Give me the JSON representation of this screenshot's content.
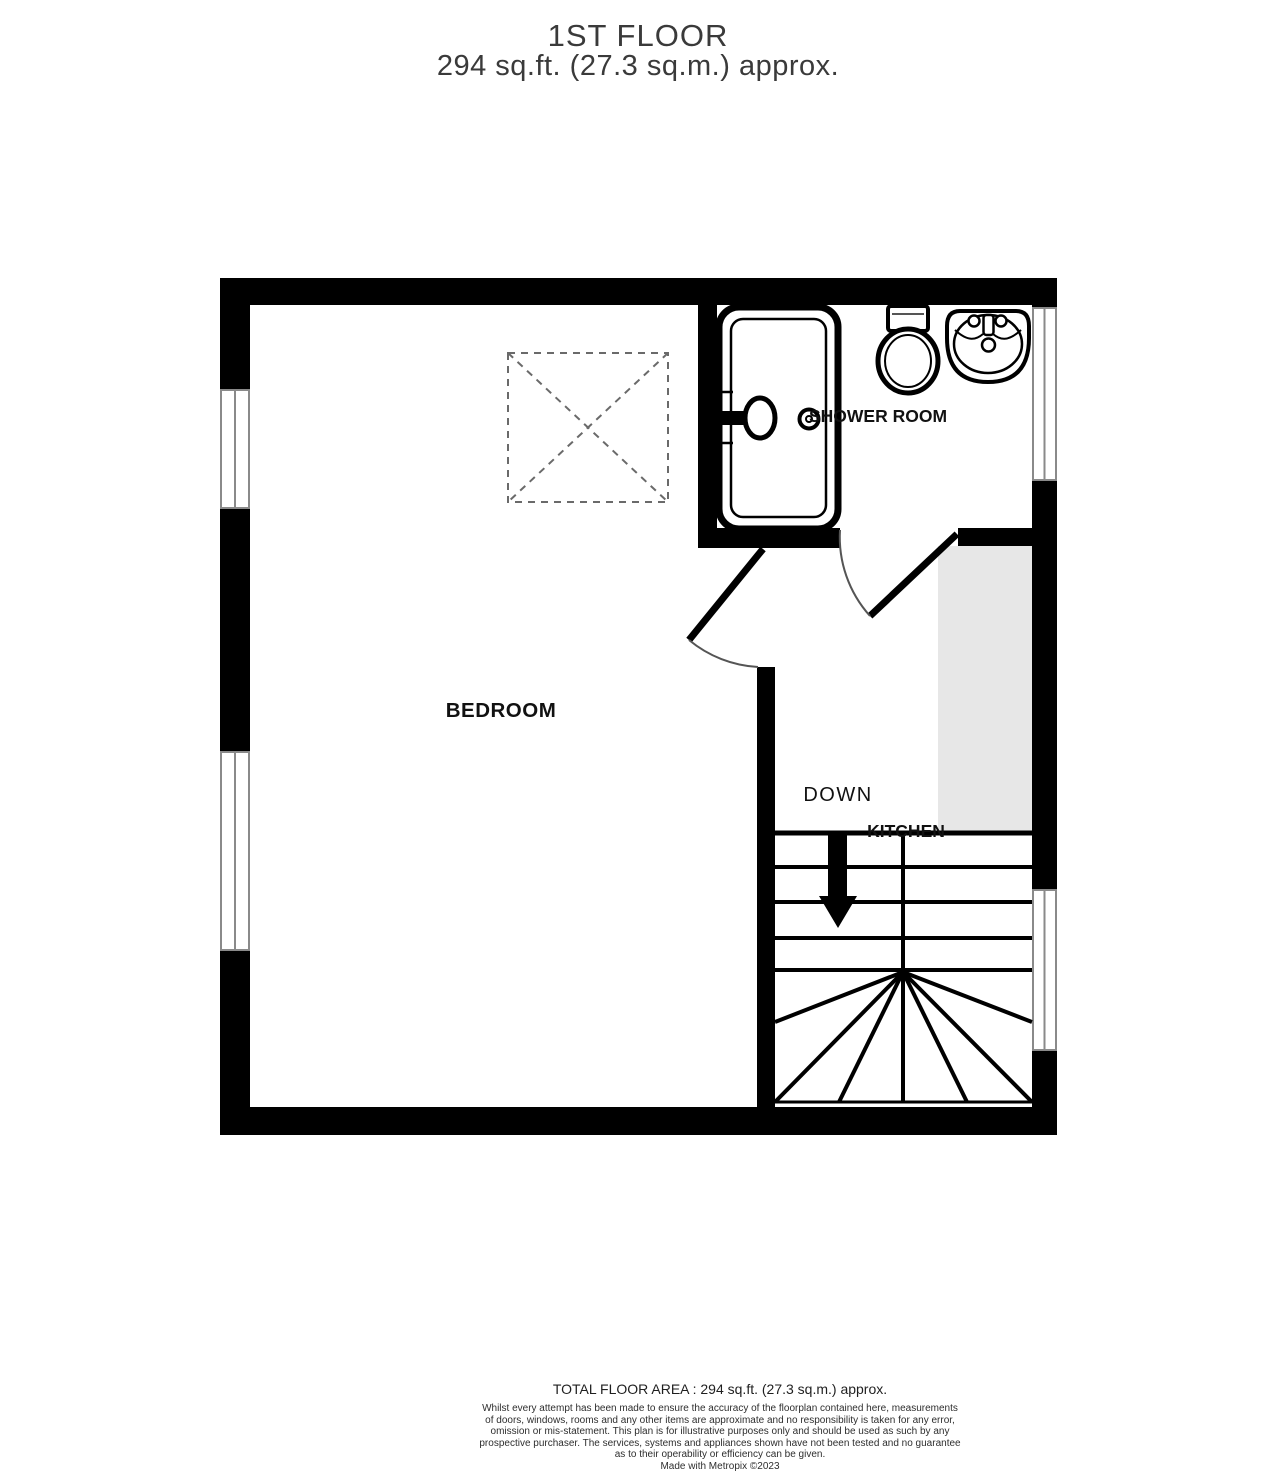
{
  "title": {
    "line1": "1ST FLOOR",
    "line2": "294 sq.ft. (27.3 sq.m.) approx."
  },
  "rooms": {
    "bedroom": "BEDROOM",
    "shower_room": "SHOWER ROOM",
    "kitchen": "KITCHEN"
  },
  "stairs": {
    "direction_label": "DOWN"
  },
  "footer": {
    "total_area": "TOTAL FLOOR AREA : 294 sq.ft. (27.3 sq.m.) approx.",
    "disclaimer_lines": [
      "Whilst every attempt has been made to ensure the accuracy of the floorplan contained here, measurements",
      "of doors, windows, rooms and any other items are approximate and no responsibility is taken for any error,",
      "omission or mis-statement. This plan is for illustrative purposes only and should be used as such by any",
      "prospective purchaser. The services, systems and appliances shown have not been tested and no guarantee",
      "as to their operability or efficiency can be given.",
      "Made with Metropix ©2023"
    ]
  },
  "colors": {
    "wall": "#000000",
    "void_fill": "#e7e7e7",
    "window_frame": "#8a8a8a",
    "skylight_dash": "#6a6a6a",
    "door_arc": "#555555"
  }
}
